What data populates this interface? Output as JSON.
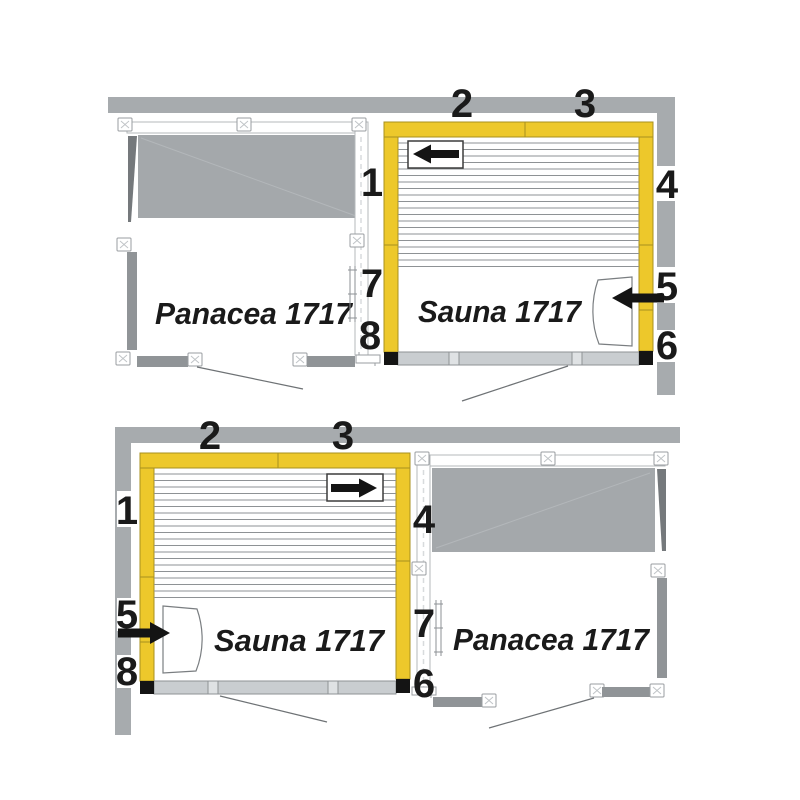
{
  "part_numbers": {
    "n1": "1",
    "n2": "2",
    "n3": "3",
    "n4": "4",
    "n5": "5",
    "n6": "6",
    "n7": "7",
    "n8": "8"
  },
  "diagrams": {
    "top": {
      "left_room": "Panacea 1717",
      "right_room": "Sauna 1717"
    },
    "bottom": {
      "left_room": "Sauna 1717",
      "right_room": "Panacea 1717"
    }
  },
  "colors": {
    "wall_gray": "#a7abae",
    "panel_gray": "#a4a8ab",
    "dark_gray": "#75797c",
    "seg_gray": "#909497",
    "yellow": "#edc82b",
    "yellow_border": "#a8901f",
    "front_gray": "#c9cdd0",
    "frame_border": "#b4b8bb",
    "line_gray": "#6e7275",
    "text": "#1a1a1a"
  }
}
